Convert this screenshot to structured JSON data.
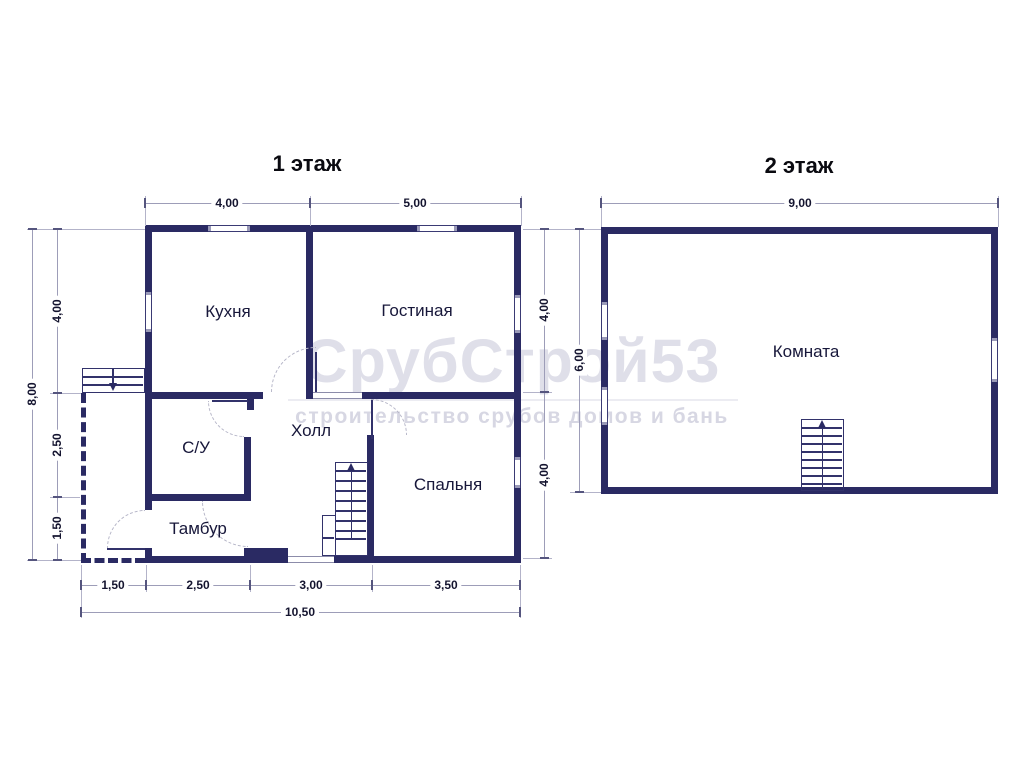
{
  "floor1": {
    "title": "1 этаж",
    "rooms": {
      "kitchen": "Кухня",
      "living_room": "Гостиная",
      "hall": "Холл",
      "bathroom": "С/У",
      "vestibule": "Тамбур",
      "bedroom": "Спальня"
    },
    "dimensions": {
      "top_kitchen": "4,00",
      "top_living": "5,00",
      "left_total": "8,00",
      "left_upper": "4,00",
      "left_middle": "2,50",
      "left_lower": "1,50",
      "right_upper": "4,00",
      "right_lower": "4,00",
      "bottom_porch": "1,50",
      "bottom_vestibule": "2,50",
      "bottom_hall": "3,00",
      "bottom_bedroom": "3,50",
      "bottom_total": "10,50"
    }
  },
  "floor2": {
    "title": "2 этаж",
    "rooms": {
      "room": "Комната"
    },
    "dimensions": {
      "top_width": "9,00",
      "left_height": "6,00"
    }
  },
  "watermark": {
    "brand": "СрубСтрой53",
    "tagline": "строительство срубов домов и бань"
  },
  "colors": {
    "wall": "#2a2a63",
    "dim_line": "#9d9db8",
    "dim_text": "#14142f",
    "watermark_text": "#dfdfe9"
  }
}
